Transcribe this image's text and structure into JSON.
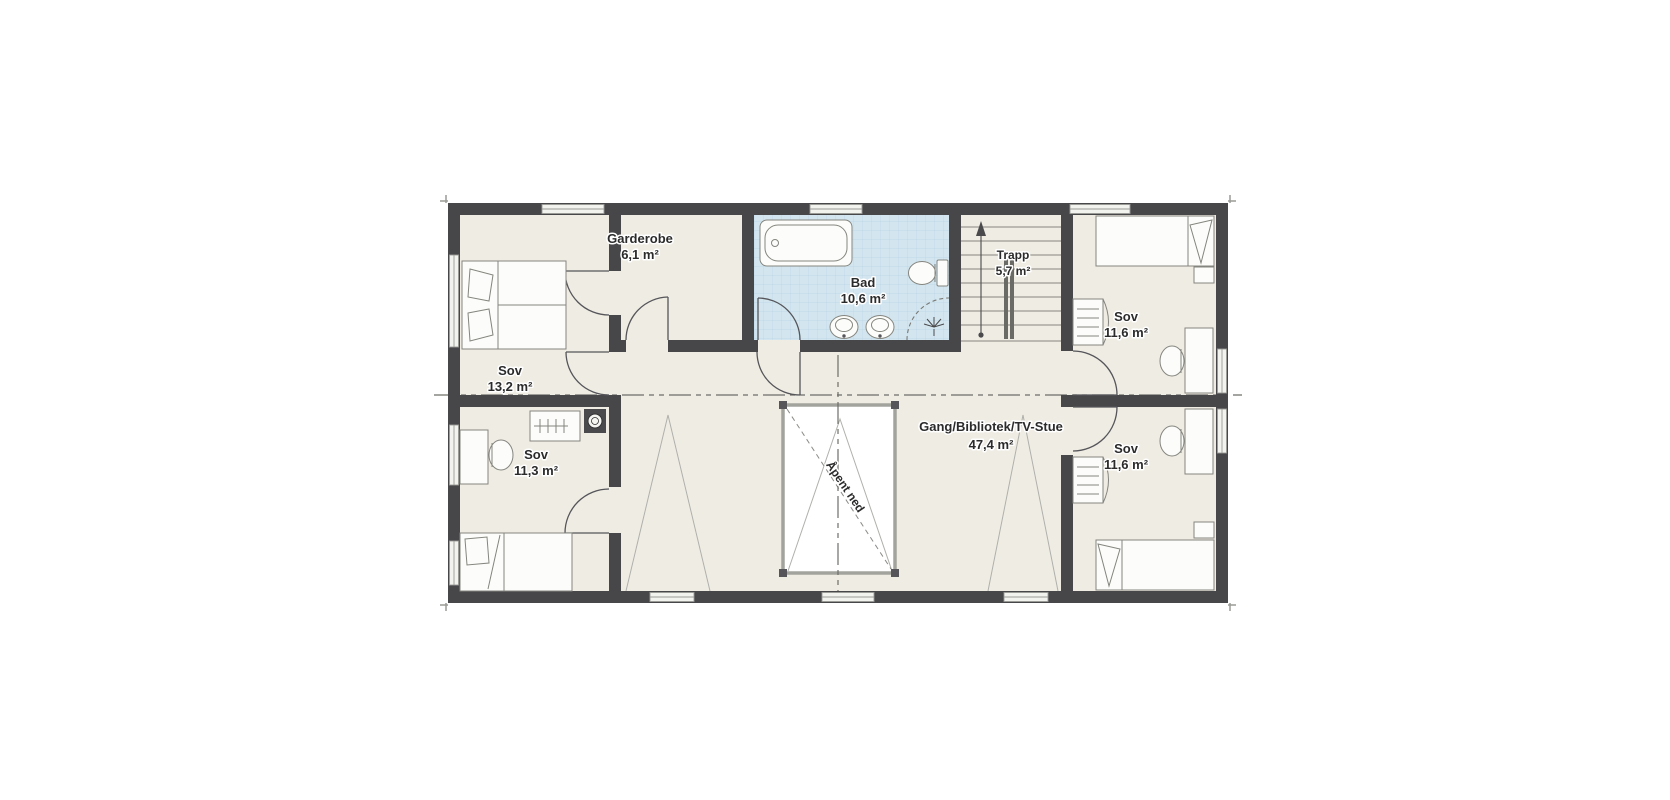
{
  "canvas": {
    "background": "#ffffff"
  },
  "plan": {
    "colors": {
      "wall": "#47474a",
      "floor": "#efece3",
      "bath_floor": "#d3e6f0",
      "bath_tile_line": "#b9d4e3",
      "void_fill": "#ffffff",
      "furniture_line": "#85857f",
      "text": "#2b2b2b"
    },
    "rooms": [
      {
        "name": "Sov",
        "area": "13,2 m²"
      },
      {
        "name": "Garderobe",
        "area": "6,1 m²"
      },
      {
        "name": "Bad",
        "area": "10,6 m²"
      },
      {
        "name": "Trapp",
        "area": "5,7 m²"
      },
      {
        "name": "Sov",
        "area": "11,6 m²"
      },
      {
        "name": "Sov",
        "area": "11,6 m²"
      },
      {
        "name": "Sov",
        "area": "11,3 m²"
      },
      {
        "name": "Gang/Bibliotek/TV-Stue",
        "area": "47,4 m²"
      }
    ],
    "annotations": {
      "open_below": "Åpent ned"
    }
  }
}
